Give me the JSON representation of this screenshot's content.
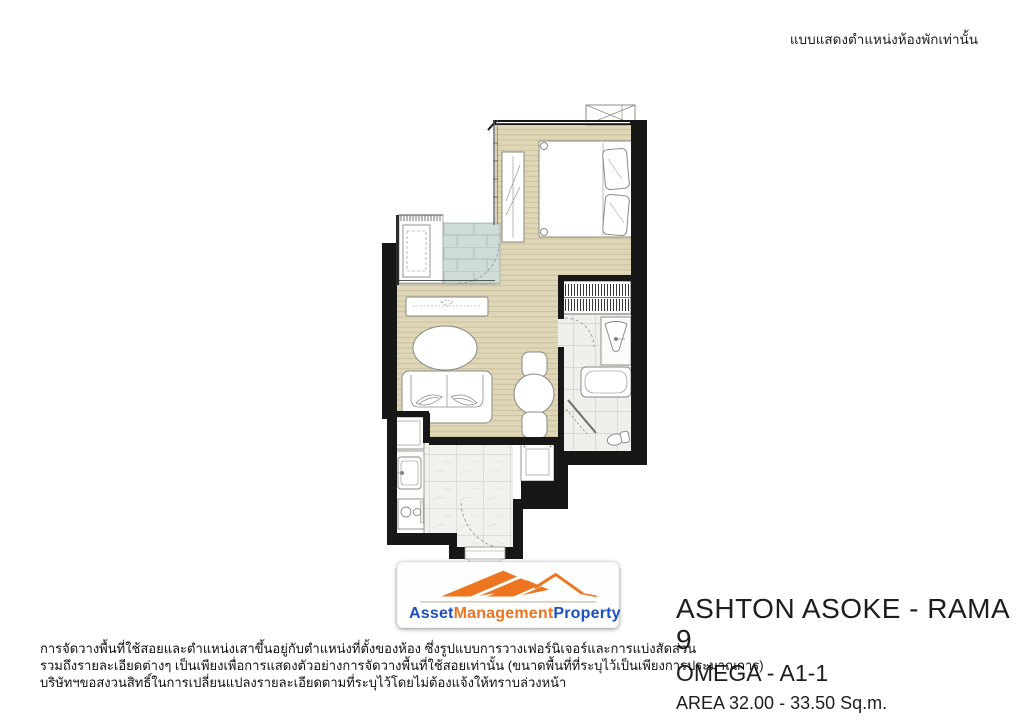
{
  "header": {
    "note_th": "แบบแสดงตำแหน่งห้องพักเท่านั้น"
  },
  "logo": {
    "words": [
      {
        "text": "Asset",
        "color": "#1d4fc0"
      },
      {
        "text": "Management",
        "color": "#ee7420"
      },
      {
        "text": "Property",
        "color": "#1d4fc0"
      }
    ]
  },
  "title": {
    "project": "ASHTON ASOKE - RAMA 9",
    "unit": "OMEGA - A1-1",
    "area": "AREA 32.00 - 33.50 Sq.m."
  },
  "disclaimer": {
    "line1": "การจัดวางพื้นที่ใช้สอยและตำแหน่งเสาขึ้นอยู่กับตำแหน่งที่ตั้งของห้อง ซึ่งรูปแบบการวางเฟอร์นิเจอร์และการแบ่งสัดส่วน",
    "line2": "รวมถึงรายละเอียดต่างๆ เป็นเพียงเพื่อการแสดงตัวอย่างการจัดวางพื้นที่ใช้สอยเท่านั้น (ขนาดพื้นที่ที่ระบุไว้เป็นเพียงการประมาณการ)",
    "line3": "บริษัทฯขอสงวนสิทธิ์ในการเปลี่ยนแปลงรายละเอียดตามที่ระบุไว้โดยไม่ต้องแจ้งให้ทราบล่วงหน้า"
  },
  "floorplan": {
    "type": "unit-floor-plan",
    "colors": {
      "wall": "#171717",
      "wood_floor": "#ded6b6",
      "wood_line": "#c8bf9b",
      "wet_tile": "#cfdbd8",
      "marble": "#eff0eb",
      "furniture_fill": "#ffffff",
      "furniture_stroke": "#8a8a82",
      "logo_orange": "#ee7420",
      "logo_blue": "#1d4fc0"
    }
  }
}
